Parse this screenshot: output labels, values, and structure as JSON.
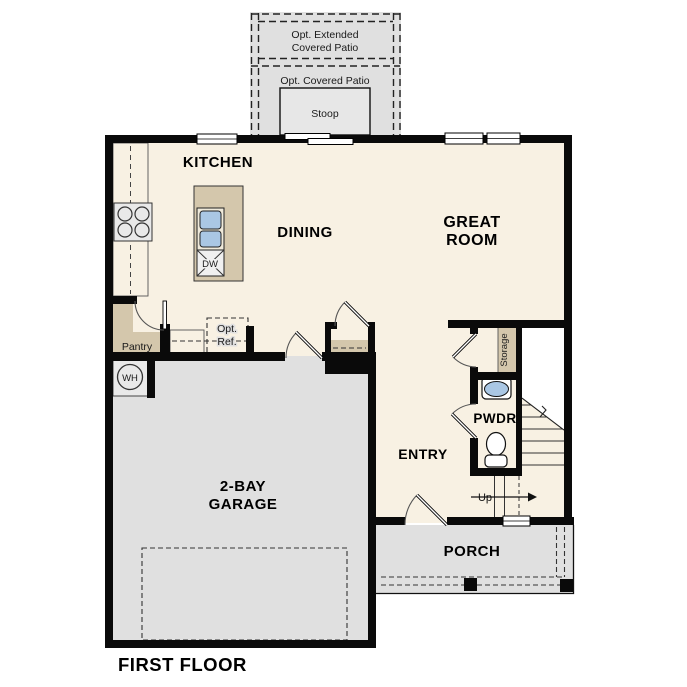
{
  "colors": {
    "floor": "#f8f1e3",
    "tan": "#d4c7ac",
    "gray": "#e0e0e0",
    "lightgray": "#e9e9e9",
    "wall": "#0a0a0a",
    "blue": "#aac7e4"
  },
  "patio": {
    "ext1": "Opt. Extended",
    "ext2": "Covered Patio",
    "covered": "Opt. Covered Patio",
    "stoop": "Stoop"
  },
  "rooms": {
    "kitchen": "KITCHEN",
    "dining": "DINING",
    "great1": "GREAT",
    "great2": "ROOM",
    "garage1": "2-BAY",
    "garage2": "GARAGE",
    "entry": "ENTRY",
    "pwdr": "PWDR",
    "porch": "PORCH",
    "pantry": "Pantry",
    "storage": "Storage"
  },
  "misc": {
    "first_floor": "FIRST FLOOR",
    "up": "Up",
    "wh": "WH",
    "dw": "DW",
    "ref1": "Opt.",
    "ref2": "Ref."
  }
}
